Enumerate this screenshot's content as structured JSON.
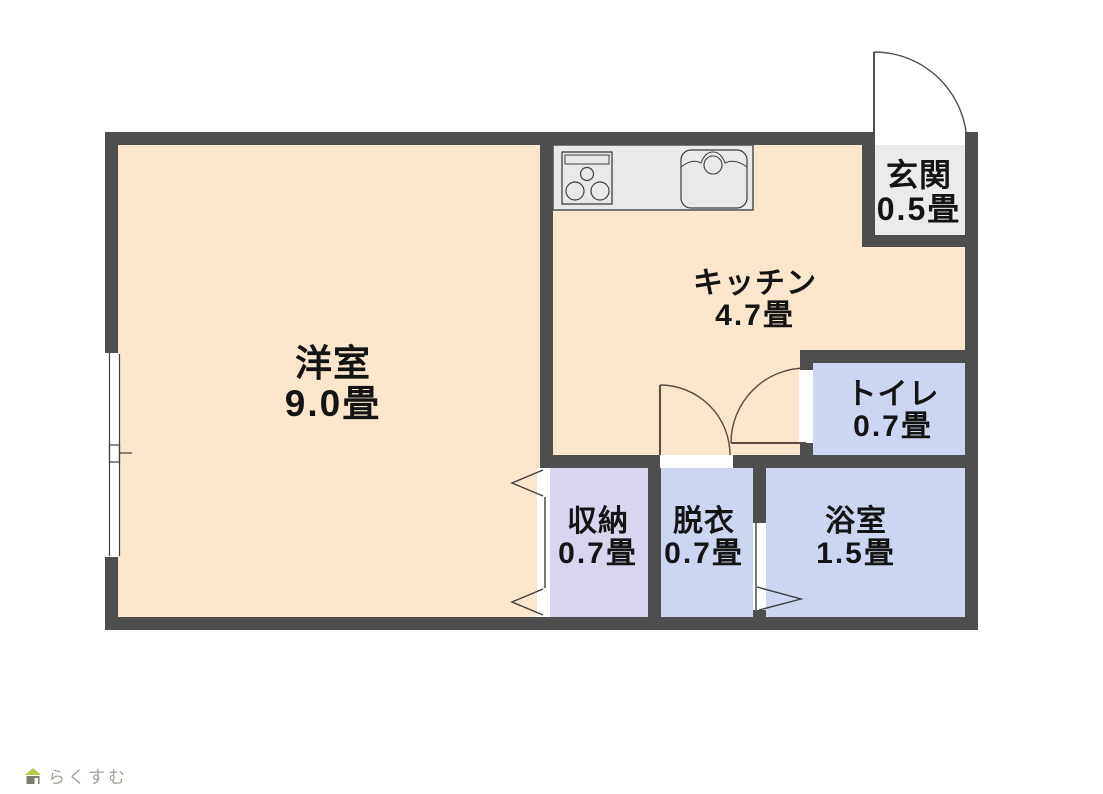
{
  "floorplan": {
    "title": "apartment-floorplan",
    "rooms": [
      {
        "name": "洋室",
        "size": "9.0畳"
      },
      {
        "name": "キッチン",
        "size": "4.7畳"
      },
      {
        "name": "玄関",
        "size": "0.5畳"
      },
      {
        "name": "トイレ",
        "size": "0.7畳"
      },
      {
        "name": "収納",
        "size": "0.7畳"
      },
      {
        "name": "脱衣",
        "size": "0.7畳"
      },
      {
        "name": "浴室",
        "size": "1.5畳"
      }
    ],
    "colors": {
      "wall": "#4e4e4e",
      "room_cream": "#fae6cd",
      "room_blue": "#cdd6f1",
      "room_lavender": "#d9d5ee",
      "room_gray": "#ebebeb",
      "counter_gray": "#e9e9e9",
      "door_line": "#5a4b43",
      "fixture_line": "#3f3f3f"
    },
    "fixtures": [
      "stove-icon",
      "sink-icon",
      "entrance-swing-door",
      "toilet-swing-door",
      "dressing-swing-door",
      "bath-folding-door",
      "closet-folding-door",
      "sliding-window"
    ],
    "branding": {
      "logo_text": "らくすむ"
    }
  }
}
